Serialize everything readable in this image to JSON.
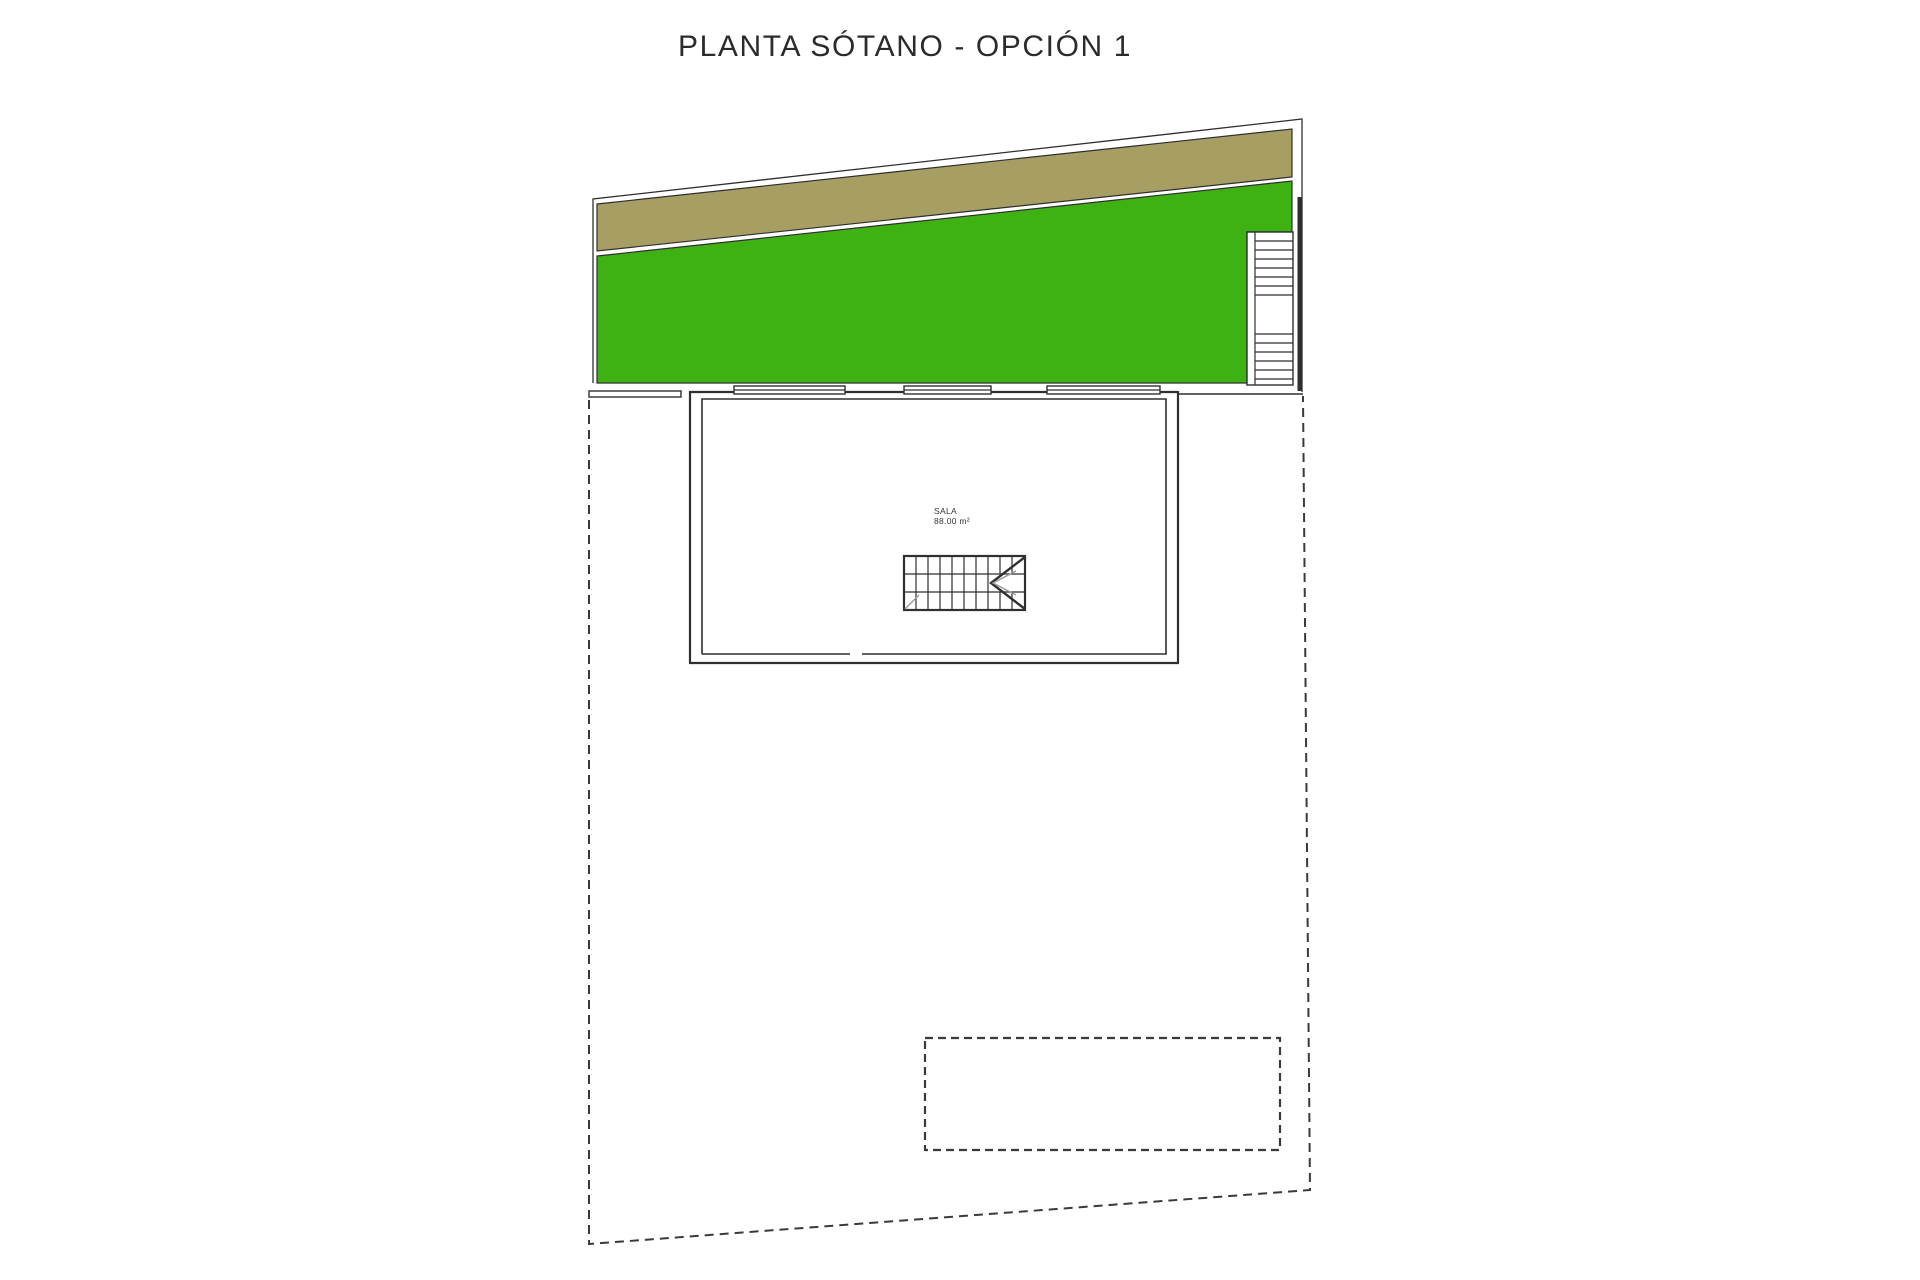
{
  "title": "PLANTA SÓTANO - OPCIÓN 1",
  "room": {
    "name": "SALA",
    "area": "88.00 m²"
  },
  "colors": {
    "background": "#ffffff",
    "grass": "#3eb212",
    "soil": "#a69e63",
    "line": "#2f2f2f",
    "dashed_line": "#3a3a3a",
    "text": "#2b2b2b"
  }
}
